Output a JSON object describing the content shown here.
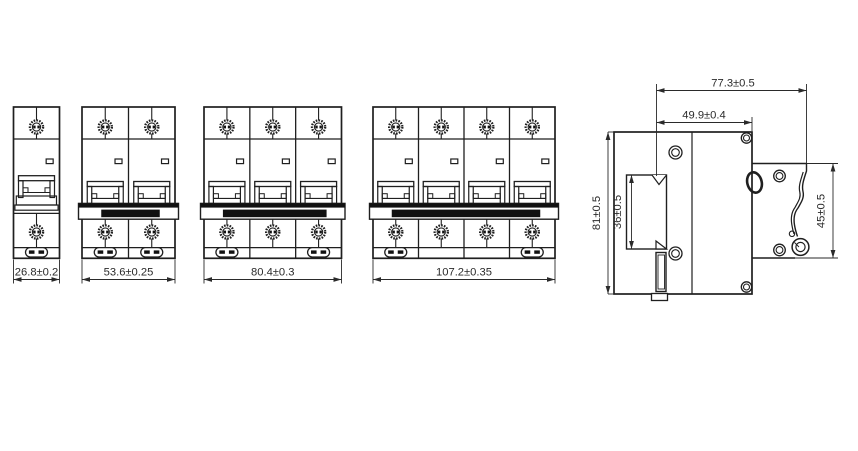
{
  "page": {
    "background": "#ffffff"
  },
  "drawing": {
    "line_color": "#1f1f1f",
    "dim_color": "#2a2a2a",
    "fill_black": "#111111"
  },
  "front_views": [
    {
      "id": "front-view-1-pole",
      "poles": 1,
      "dimension_label": "26.8±0.2"
    },
    {
      "id": "front-view-2-pole",
      "poles": 2,
      "dimension_label": "53.6±0.25"
    },
    {
      "id": "front-view-3-pole",
      "poles": 3,
      "dimension_label": "80.4±0.3"
    },
    {
      "id": "front-view-4-pole",
      "poles": 4,
      "dimension_label": "107.2±0.35"
    }
  ],
  "side_view": {
    "id": "side-view",
    "dimension_labels": {
      "overall_depth": "77.3±0.5",
      "upper_depth": "49.9±0.4",
      "overall_height": "81±0.5",
      "din_slot_height": "36±0.5",
      "front_section_height": "45±0.5"
    }
  }
}
